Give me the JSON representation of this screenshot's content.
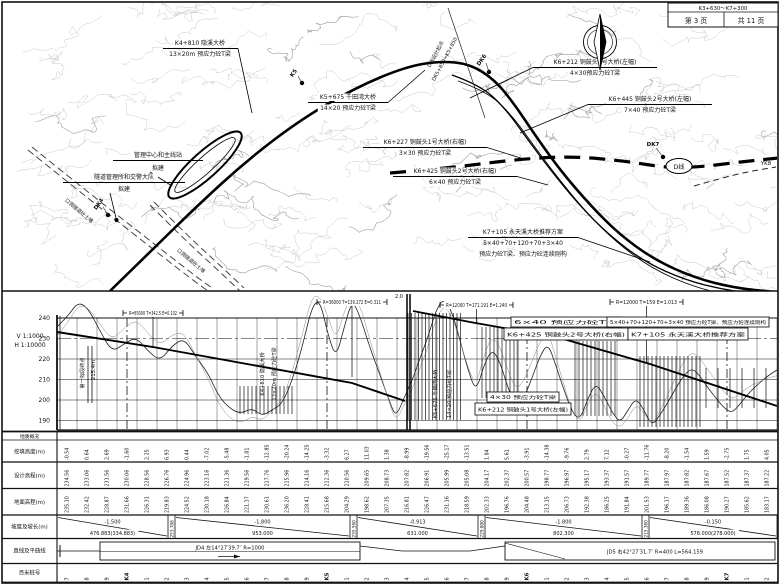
{
  "title_block": {
    "range": "K3+630～K7+300",
    "page": "第 3 页",
    "total": "共 11 页"
  },
  "plan": {
    "north_icon": "compass-north-arrow",
    "dline_label": "D线",
    "yk_label": "YK8",
    "start_note": [
      "D线设计起点",
      "DK5+850=K5+850"
    ],
    "road_side_texts": [
      "口洞隧道砼土堆",
      "口洞隧道砼土堆"
    ],
    "markers": [
      {
        "label": "K5",
        "x": 302,
        "y": 83,
        "lx": 295,
        "ly": 74,
        "rot": -55
      },
      {
        "label": "DK6",
        "x": 489,
        "y": 72,
        "lx": 483,
        "ly": 61,
        "rot": -55
      },
      {
        "label": "DK7",
        "x": 663,
        "y": 157,
        "lx": 653,
        "ly": 146,
        "rot": 0
      },
      {
        "label": "DK4",
        "x": 108,
        "y": 215,
        "lx": 100,
        "ly": 205,
        "rot": -55
      }
    ],
    "labels": [
      {
        "cx": 200,
        "lines": [
          "K4+810 隐溪大桥",
          "13×20m 预应力砼T梁"
        ],
        "ys": [
          45,
          56
        ],
        "ul": [
          163,
          238,
          48.5
        ],
        "leader": [
          [
            238,
            48.5
          ],
          [
            252,
            113
          ]
        ]
      },
      {
        "cx": 348,
        "lines": [
          "K5+675 千田湾大桥",
          "14×20 预应力砼T梁"
        ],
        "ys": [
          99,
          110
        ],
        "ul": [
          308,
          388,
          102.5
        ],
        "leader": [
          [
            388,
            102.5
          ],
          [
            425,
            70
          ]
        ]
      },
      {
        "cx": 595,
        "lines": [
          "K6+212 铜鼓头1号大桥(左幅)",
          "4×30预应力砼T梁"
        ],
        "ys": [
          64,
          75
        ],
        "ul": [
          533,
          657,
          67.5
        ],
        "leader": [
          [
            533,
            67.5
          ],
          [
            470,
            98
          ]
        ]
      },
      {
        "cx": 650,
        "lines": [
          "K6+445 铜鼓头2号大桥(左幅)",
          "7×40 预应力砼T梁"
        ],
        "ys": [
          101,
          112
        ],
        "ul": [
          588,
          712,
          104.5
        ],
        "leader": [
          [
            588,
            104.5
          ],
          [
            520,
            133
          ]
        ]
      },
      {
        "cx": 425,
        "lines": [
          "K6+227 铜鼓头1号大桥(右幅)",
          "3×30 预应力砼T梁"
        ],
        "ys": [
          144,
          155
        ],
        "ul": [
          363,
          487,
          147.5
        ],
        "leader": [
          [
            487,
            147.5
          ],
          [
            527,
            160
          ]
        ]
      },
      {
        "cx": 455,
        "lines": [
          "K6+425 铜鼓头2号大桥(右幅)",
          "6×40 预应力砼T梁"
        ],
        "ys": [
          173,
          184
        ],
        "ul": [
          393,
          517,
          176.5
        ],
        "leader": [
          [
            517,
            176.5
          ],
          [
            548,
            185
          ]
        ]
      },
      {
        "cx": 523,
        "lines": [
          "K7+105 永天溪大桥推荐方案",
          "5×40+70+120+70+3×40",
          "预应力砼T梁、预应力砼连续刚构"
        ],
        "ys": [
          234,
          245,
          256
        ],
        "ul": [
          468,
          578,
          237.5
        ],
        "leader": [
          [
            578,
            237.5
          ],
          [
            650,
            262
          ]
        ]
      },
      {
        "cx": 158,
        "lines": [
          "管理中心和主线站",
          "拟建"
        ],
        "ys": [
          157,
          170
        ],
        "ul": [
          113,
          203,
          160.5
        ],
        "leader": [
          [
            150,
            172
          ],
          [
            172,
            186
          ]
        ]
      },
      {
        "cx": 124,
        "lines": [
          "隧道管理所和交警大队",
          "拟建"
        ],
        "ys": [
          179,
          191
        ],
        "ul": [
          63,
          185,
          182.5
        ],
        "leader": [
          [
            110,
            193
          ],
          [
            116,
            218
          ]
        ],
        "dot": [
          116.5,
          220
        ]
      }
    ]
  },
  "profile": {
    "scale_v": "V 1:1000",
    "scale_h": "H 1:10000",
    "elevations": [
      240,
      230,
      220,
      210,
      200,
      190
    ],
    "splice_label": "2.0",
    "curve_boxes": [
      {
        "text": "R=85000 T=342.5 E=0.102",
        "x0": 123,
        "x1": 183,
        "y": 313,
        "stem_y": 347
      },
      {
        "text": "R=36000 T=139.272 E=0.311",
        "x0": 317,
        "x1": 387,
        "y": 302,
        "stem_y": 377
      },
      {
        "text": "R=12000 T=171.191 E=1.240",
        "x0": 440,
        "x1": 513,
        "y": 305,
        "stem_y": 324
      },
      {
        "text": "R=12000 T=159 E=1.013",
        "x0": 610,
        "x1": 683,
        "y": 302,
        "stem_y": 363
      }
    ],
    "bridge_boxes": [
      {
        "l1": "6×40 预应力砼T梁",
        "l2": "K6+425 铜鼓头2号大桥(右幅)",
        "cx": 566,
        "y": 317,
        "w1": 110,
        "w2": 124
      },
      {
        "l1": "5×40+70+120+70+3×40 预应力砼T梁、预应力砼连续刚构",
        "l2": "K7+105 永天溪大桥推荐方案",
        "cx": 688,
        "y": 317,
        "w1": 162,
        "w2": 120
      },
      {
        "l1": "4×30 预应力砼T梁",
        "l2": "K6+212 铜鼓头1号大桥(左幅)",
        "cx": 523,
        "y": 392,
        "w1": 72,
        "w2": 96
      }
    ],
    "vertical_texts": [
      {
        "t": "第一标段终点",
        "x": 84,
        "y": 373
      },
      {
        "t": "215.4m",
        "x": 95,
        "y": 370
      },
      {
        "t": "K4+810 隐溪大桥",
        "x": 264,
        "y": 374
      },
      {
        "t": "13×20m 预应力砼T梁",
        "x": 276,
        "y": 374
      },
      {
        "t": "K5+675 千田湾大桥",
        "x": 437,
        "y": 394
      },
      {
        "t": "14×20 预应力砼T梁",
        "x": 451,
        "y": 394
      }
    ],
    "geometry": {
      "design_left": [
        [
          57,
          332
        ],
        [
          153,
          347
        ],
        [
          352,
          383
        ],
        [
          405,
          401
        ]
      ],
      "design_right": [
        [
          413,
          311
        ],
        [
          470,
          322
        ],
        [
          560,
          338
        ],
        [
          650,
          364
        ],
        [
          777,
          406
        ]
      ],
      "ground": [
        [
          57,
          327
        ],
        [
          68,
          316
        ],
        [
          78,
          302
        ],
        [
          88,
          308
        ],
        [
          100,
          331
        ],
        [
          112,
          352
        ],
        [
          124,
          344
        ],
        [
          136,
          337
        ],
        [
          148,
          351
        ],
        [
          160,
          361
        ],
        [
          172,
          346
        ],
        [
          184,
          338
        ],
        [
          196,
          357
        ],
        [
          208,
          373
        ],
        [
          218,
          395
        ],
        [
          228,
          407
        ],
        [
          240,
          414
        ],
        [
          252,
          408
        ],
        [
          262,
          416
        ],
        [
          272,
          410
        ],
        [
          282,
          404
        ],
        [
          292,
          381
        ],
        [
          302,
          348
        ],
        [
          312,
          306
        ],
        [
          320,
          300
        ],
        [
          328,
          335
        ],
        [
          336,
          358
        ],
        [
          344,
          328
        ],
        [
          352,
          300
        ],
        [
          360,
          316
        ],
        [
          370,
          348
        ],
        [
          380,
          375
        ],
        [
          390,
          403
        ],
        [
          396,
          417
        ],
        [
          404,
          398
        ],
        [
          412,
          381
        ],
        [
          420,
          358
        ],
        [
          428,
          337
        ],
        [
          436,
          310
        ],
        [
          444,
          298
        ],
        [
          452,
          312
        ],
        [
          460,
          340
        ],
        [
          468,
          370
        ],
        [
          476,
          392
        ],
        [
          484,
          365
        ],
        [
          492,
          349
        ],
        [
          500,
          362
        ],
        [
          508,
          388
        ],
        [
          516,
          408
        ],
        [
          524,
          398
        ],
        [
          532,
          378
        ],
        [
          540,
          356
        ],
        [
          548,
          343
        ],
        [
          556,
          366
        ],
        [
          564,
          390
        ],
        [
          572,
          412
        ],
        [
          580,
          420
        ],
        [
          588,
          398
        ],
        [
          596,
          383
        ],
        [
          604,
          396
        ],
        [
          612,
          412
        ],
        [
          620,
          423
        ],
        [
          628,
          410
        ],
        [
          636,
          398
        ],
        [
          644,
          410
        ],
        [
          652,
          426
        ],
        [
          660,
          415
        ],
        [
          668,
          402
        ],
        [
          676,
          388
        ],
        [
          684,
          375
        ],
        [
          692,
          368
        ],
        [
          700,
          376
        ],
        [
          708,
          388
        ],
        [
          716,
          398
        ],
        [
          724,
          408
        ],
        [
          732,
          413
        ],
        [
          740,
          404
        ],
        [
          748,
          394
        ],
        [
          756,
          386
        ],
        [
          764,
          379
        ],
        [
          772,
          373
        ],
        [
          777,
          370
        ]
      ],
      "hatch": [
        [
          240,
          292,
          386,
          414,
          4
        ],
        [
          408,
          462,
          313,
          420,
          3.5
        ],
        [
          482,
          520,
          327,
          398,
          4
        ],
        [
          575,
          615,
          341,
          416,
          4
        ],
        [
          640,
          700,
          356,
          427,
          4
        ],
        [
          706,
          768,
          368,
          408,
          12
        ]
      ],
      "km_lines": [
        127,
        327,
        527,
        727
      ]
    }
  },
  "table": {
    "row_headers": [
      "地质概况",
      "挖填高度(m)",
      "设计高程(m)",
      "地面高程(m)",
      "坡度及坡长(m)",
      "直线及平曲线",
      "百米桩号"
    ],
    "cut_fill": [
      "-0.54",
      "0.64",
      "2.69",
      "-1.60",
      "2.25",
      "6.93",
      "0.44",
      "-7.02",
      "-5.48",
      "-1.81",
      "-12.85",
      "-20.24",
      "-14.25",
      "-3.32",
      "6.27",
      "11.03",
      "1.38",
      "-8.99",
      "-19.56",
      "-25.17",
      "-13.51",
      "1.84",
      "5.61",
      "-3.91",
      "-14.38",
      "-9.76",
      "2.79",
      "7.12",
      "-0.27",
      "-11.76",
      "-8.20",
      "-1.54",
      "1.59",
      "-2.75",
      "1.75",
      "4.05"
    ],
    "design_elev": [
      "234.56",
      "233.06",
      "231.56",
      "230.06",
      "228.56",
      "226.76",
      "224.96",
      "223.16",
      "221.36",
      "219.56",
      "217.76",
      "215.96",
      "214.16",
      "212.36",
      "210.56",
      "209.65",
      "208.73",
      "207.82",
      "206.91",
      "205.99",
      "205.08",
      "204.17",
      "202.37",
      "200.57",
      "198.77",
      "196.97",
      "195.17",
      "193.37",
      "191.57",
      "189.77",
      "187.97",
      "187.82",
      "187.67",
      "187.52",
      "187.37",
      "187.22"
    ],
    "ground_elev": [
      "235.10",
      "232.42",
      "228.87",
      "231.66",
      "226.31",
      "219.83",
      "224.52",
      "230.18",
      "226.84",
      "221.37",
      "230.61",
      "236.20",
      "228.41",
      "215.68",
      "204.29",
      "198.62",
      "207.35",
      "216.81",
      "226.47",
      "231.16",
      "218.59",
      "202.33",
      "196.76",
      "204.48",
      "213.15",
      "206.73",
      "192.38",
      "186.25",
      "191.84",
      "201.53",
      "196.17",
      "189.36",
      "186.08",
      "190.27",
      "185.62",
      "183.17"
    ],
    "slopes": [
      {
        "grade": "-1.500",
        "length": "476.883(334.883)",
        "x0": 57,
        "x1": 168
      },
      {
        "grade": "-1.800",
        "length": "953.000",
        "x0": 175,
        "x1": 350
      },
      {
        "grade": "-0.913",
        "length": "631.000",
        "x0": 357,
        "x1": 478
      },
      {
        "grade": "-1.800",
        "length": "802.300",
        "x0": 485,
        "x1": 642
      },
      {
        "grade": "-0.150",
        "length": "578.000(278.000)",
        "x0": 649,
        "x1": 777
      }
    ],
    "slope_dividers": [
      {
        "x": 171.5,
        "t": "253.708"
      },
      {
        "x": 353.5,
        "t": "235.560"
      },
      {
        "x": 481.5,
        "t": "229.800"
      },
      {
        "x": 645.5,
        "t": "215.360"
      }
    ],
    "alignment": [
      {
        "text": "JD4 左14°27′39.7″ R=1000",
        "x0": 100,
        "x1": 360
      },
      {
        "text": "JD5 右42°27′31.7″ R=400 L=564.159",
        "x0": 505,
        "x1": 775
      }
    ],
    "stations": [
      "7",
      "8",
      "9",
      "K4",
      "1",
      "2",
      "3",
      "4",
      "5",
      "6",
      "7",
      "8",
      "9",
      "K5",
      "1",
      "2",
      "3",
      "4",
      "5",
      "6",
      "7",
      "8",
      "9",
      "K6",
      "1",
      "2",
      "3",
      "4",
      "5",
      "6",
      "7",
      "8",
      "9",
      "K7",
      "1",
      "2"
    ]
  }
}
